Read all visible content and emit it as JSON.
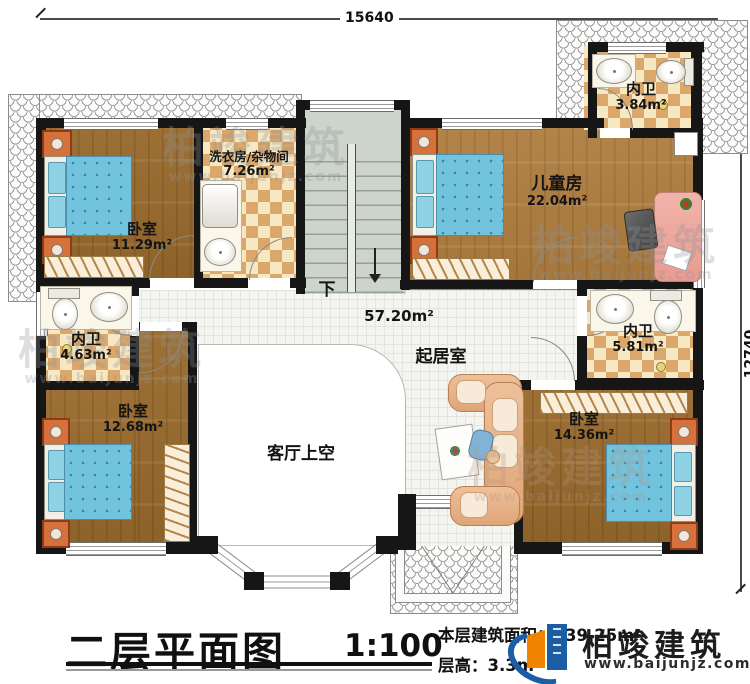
{
  "dimensions": {
    "width": "15640",
    "height": "12740"
  },
  "rooms": {
    "bedroom_tl": {
      "name": "卧室",
      "area": "11.29m²"
    },
    "laundry": {
      "name": "洗衣房/杂物间",
      "area": "7.26m²"
    },
    "bath_top": {
      "name": "内卫",
      "area": "3.84m²"
    },
    "children": {
      "name": "儿童房",
      "area": "22.04m²"
    },
    "bath_left": {
      "name": "内卫",
      "area": "4.63m²"
    },
    "bath_right": {
      "name": "内卫",
      "area": "5.81m²"
    },
    "bedroom_bl": {
      "name": "卧室",
      "area": "12.68m²"
    },
    "bedroom_br": {
      "name": "卧室",
      "area": "14.36m²"
    },
    "living": {
      "name": "起居室",
      "area": "57.20m²"
    },
    "void": {
      "name": "客厅上空"
    },
    "stairs": {
      "down_label": "下"
    }
  },
  "title_block": {
    "title": "二层平面图",
    "scale": "1:100",
    "floor_area": "本层建筑面积：139.25m²",
    "floor_height": "层高：3.3m"
  },
  "brand": {
    "name": "柏竣建筑",
    "website": "www.baijunjz.com"
  },
  "watermark": {
    "text": "柏竣建筑",
    "url": "www.baijunjz.com"
  },
  "colors": {
    "wall": "#161616",
    "wood": "#9d7136",
    "wood_light": "#b3854a",
    "tile_accent": "#dca76a",
    "bed": "#72c3dd",
    "stairs": "#cdd4ca",
    "brand_blue": "#1c5ea6",
    "brand_orange": "#f08300"
  }
}
